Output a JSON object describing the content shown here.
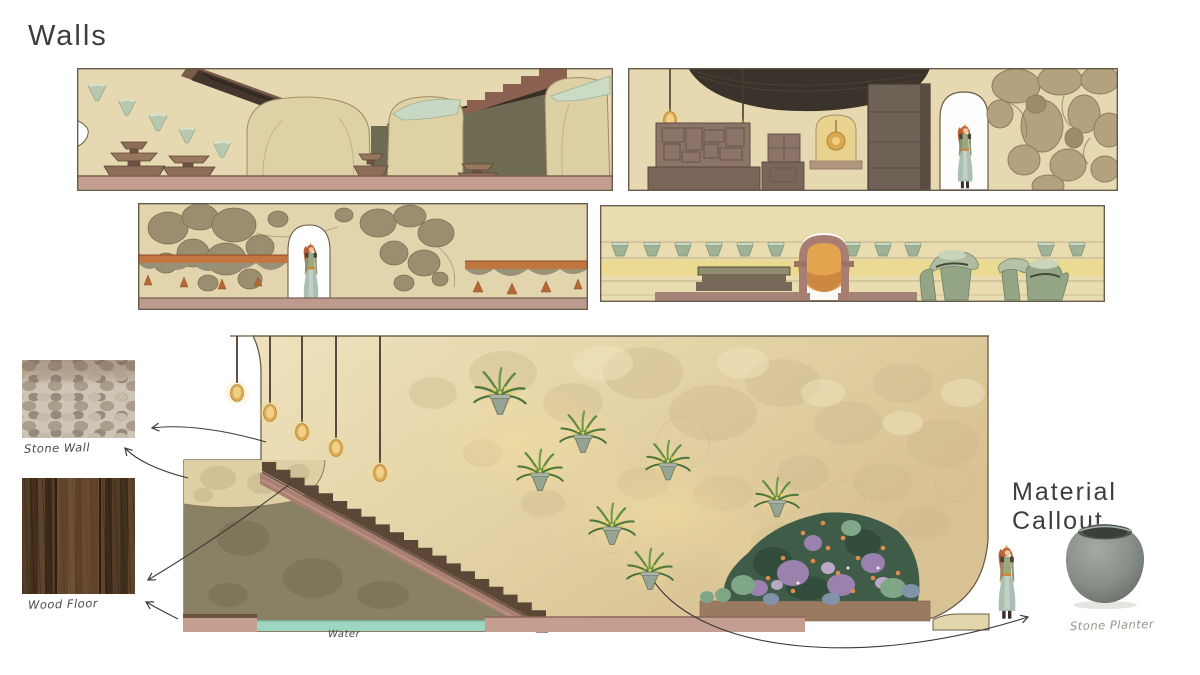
{
  "page": {
    "title": "Walls",
    "background_color": "#ffffff"
  },
  "callout": {
    "title": "Material Callout"
  },
  "materials": {
    "stone_wall": {
      "label": "Stone Wall"
    },
    "wood_floor": {
      "label": "Wood Floor"
    },
    "stone_planter": {
      "label": "Stone Planter"
    }
  },
  "main_elevation": {
    "water_label": "Water",
    "pendant_lamp_count": 5,
    "hanging_plant_count": 8
  },
  "palette": {
    "wall_beige": "#e6d8b0",
    "floor_mauve": "#c49e8f",
    "stair_mauve": "#a87f70",
    "under_stair_olive": "#8a8164",
    "water_teal": "#9fd6c2",
    "planter_sage": "#aec3a8",
    "valance_orange": "#c1763f",
    "accent_yellow": "#ebdb92",
    "lamp_gold": "#dbab55",
    "ink_outline": "#6b5c49"
  }
}
